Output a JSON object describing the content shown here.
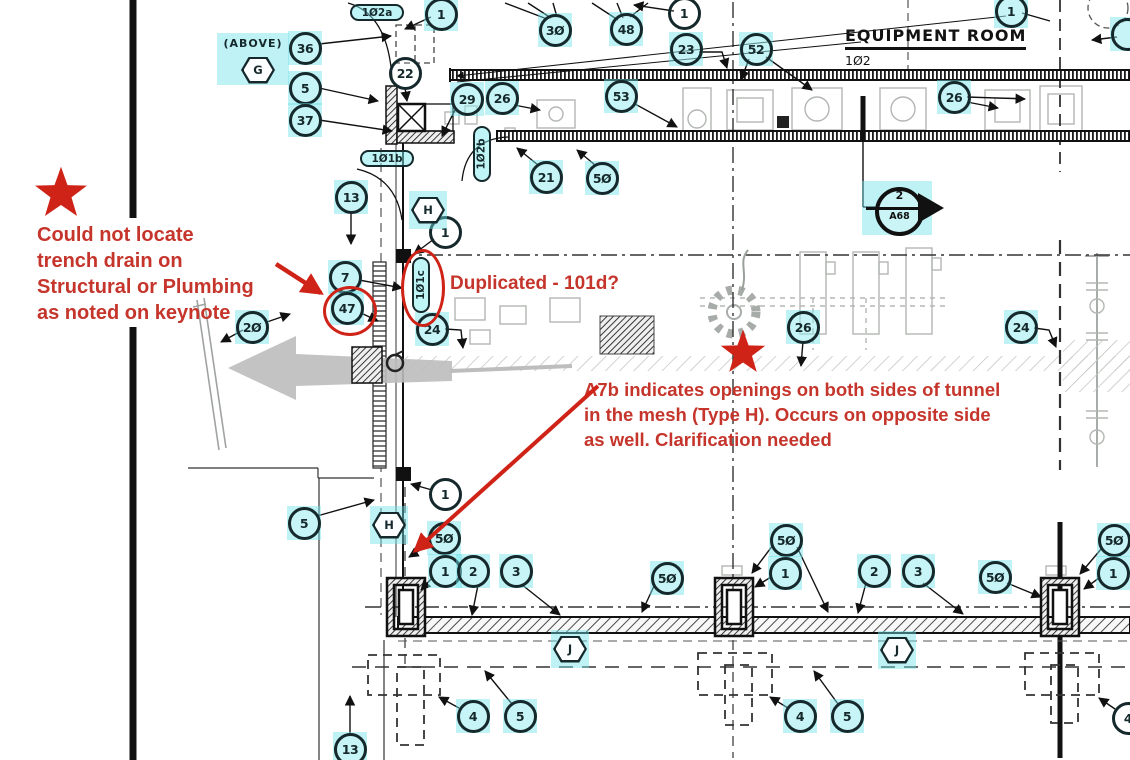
{
  "drawing": {
    "room": {
      "title": "EQUIPMENT ROOM",
      "number": "102"
    },
    "above_note": {
      "label": "(ABOVE)",
      "wall_type": "G"
    },
    "section_marker": {
      "detail_number": "2",
      "sheet": "A68"
    },
    "keynotes": [
      {
        "label": "1",
        "x": 441,
        "y": 14,
        "hl": true
      },
      {
        "label": "30",
        "x": 555,
        "y": 30,
        "hl": true
      },
      {
        "label": "48",
        "x": 626,
        "y": 29,
        "hl": true
      },
      {
        "label": "1",
        "x": 684,
        "y": 13,
        "hl": false
      },
      {
        "label": "23",
        "x": 686,
        "y": 49,
        "hl": true
      },
      {
        "label": "52",
        "x": 756,
        "y": 49,
        "hl": true
      },
      {
        "label": "26",
        "x": 954,
        "y": 97,
        "hl": true
      },
      {
        "label": "1",
        "x": 1011,
        "y": 11,
        "hl": true
      },
      {
        "label": "",
        "x": 1127,
        "y": 34,
        "hl": true
      },
      {
        "label": "29",
        "x": 467,
        "y": 99,
        "hl": true
      },
      {
        "label": "26",
        "x": 502,
        "y": 98,
        "hl": true
      },
      {
        "label": "53",
        "x": 621,
        "y": 96,
        "hl": true
      },
      {
        "label": "21",
        "x": 546,
        "y": 177,
        "hl": true
      },
      {
        "label": "50",
        "x": 602,
        "y": 178,
        "hl": true
      },
      {
        "label": "36",
        "x": 305,
        "y": 48,
        "hl": true
      },
      {
        "label": "5",
        "x": 305,
        "y": 88,
        "hl": true
      },
      {
        "label": "37",
        "x": 305,
        "y": 120,
        "hl": true
      },
      {
        "label": "22",
        "x": 405,
        "y": 73,
        "hl": false
      },
      {
        "label": "13",
        "x": 351,
        "y": 197,
        "hl": true
      },
      {
        "label": "1",
        "x": 445,
        "y": 232,
        "hl": false
      },
      {
        "label": "7",
        "x": 345,
        "y": 277,
        "hl": true
      },
      {
        "label": "47",
        "x": 347,
        "y": 308,
        "hl": true,
        "flagged": true
      },
      {
        "label": "20",
        "x": 252,
        "y": 327,
        "hl": true
      },
      {
        "label": "24",
        "x": 432,
        "y": 329,
        "hl": true
      },
      {
        "label": "26",
        "x": 803,
        "y": 327,
        "hl": true
      },
      {
        "label": "24",
        "x": 1021,
        "y": 327,
        "hl": true
      },
      {
        "label": "5",
        "x": 304,
        "y": 523,
        "hl": true
      },
      {
        "label": "1",
        "x": 445,
        "y": 494,
        "hl": false
      },
      {
        "label": "50",
        "x": 444,
        "y": 538,
        "hl": true
      },
      {
        "label": "1",
        "x": 445,
        "y": 571,
        "hl": true
      },
      {
        "label": "2",
        "x": 473,
        "y": 571,
        "hl": true
      },
      {
        "label": "3",
        "x": 516,
        "y": 571,
        "hl": true
      },
      {
        "label": "50",
        "x": 667,
        "y": 578,
        "hl": true
      },
      {
        "label": "50",
        "x": 786,
        "y": 540,
        "hl": true
      },
      {
        "label": "1",
        "x": 785,
        "y": 573,
        "hl": true
      },
      {
        "label": "2",
        "x": 874,
        "y": 571,
        "hl": true
      },
      {
        "label": "3",
        "x": 918,
        "y": 571,
        "hl": true
      },
      {
        "label": "50",
        "x": 995,
        "y": 577,
        "hl": true
      },
      {
        "label": "50",
        "x": 1114,
        "y": 540,
        "hl": true
      },
      {
        "label": "1",
        "x": 1113,
        "y": 573,
        "hl": true
      },
      {
        "label": "4",
        "x": 473,
        "y": 716,
        "hl": true
      },
      {
        "label": "5",
        "x": 520,
        "y": 716,
        "hl": true
      },
      {
        "label": "4",
        "x": 800,
        "y": 716,
        "hl": true
      },
      {
        "label": "5",
        "x": 847,
        "y": 716,
        "hl": true
      },
      {
        "label": "4",
        "x": 1128,
        "y": 718,
        "hl": false
      },
      {
        "label": "13",
        "x": 350,
        "y": 749,
        "hl": true
      }
    ],
    "wall_type_tags": [
      {
        "label": "G",
        "x": 258,
        "y": 70,
        "hl": false
      },
      {
        "label": "H",
        "x": 428,
        "y": 210,
        "hl": true
      },
      {
        "label": "H",
        "x": 389,
        "y": 525,
        "hl": true
      },
      {
        "label": "J",
        "x": 570,
        "y": 649,
        "hl": true
      },
      {
        "label": "J",
        "x": 897,
        "y": 650,
        "hl": true
      }
    ],
    "door_tags": [
      {
        "label": "102a",
        "x": 377,
        "y": 13,
        "orient": "h"
      },
      {
        "label": "101b",
        "x": 387,
        "y": 159,
        "orient": "h"
      },
      {
        "label": "102b",
        "x": 482,
        "y": 154,
        "orient": "v"
      },
      {
        "label": "101c",
        "x": 421,
        "y": 285,
        "orient": "v",
        "flagged": true
      }
    ]
  },
  "markup": {
    "notes": [
      {
        "id": "note-trench",
        "lines": [
          "Could not locate",
          "trench drain on",
          "Structural or Plumbing",
          "as noted on keynote"
        ],
        "x": 37,
        "y": 222,
        "font_px": 20,
        "line_px": 26
      },
      {
        "id": "note-duplicated",
        "lines": [
          "Duplicated - 101d?"
        ],
        "x": 450,
        "y": 272,
        "font_px": 19,
        "line_px": 24
      },
      {
        "id": "note-a7b",
        "lines": [
          "A7b indicates openings on both sides of tunnel",
          "in the mesh (Type H). Occurs on opposite side",
          "as well. Clarification needed"
        ],
        "x": 584,
        "y": 377,
        "font_px": 18.5,
        "line_px": 25
      }
    ],
    "stars": [
      {
        "x": 61,
        "y": 194,
        "scale": 1.05
      },
      {
        "x": 743,
        "y": 353,
        "scale": 0.9
      }
    ],
    "flagged_keynote": "47",
    "flagged_door_tag": "101c"
  },
  "colors": {
    "highlight_cyan": "rgba(110,226,232,0.45)",
    "ink": "#15282b",
    "markup_red": "#cf2318",
    "markup_red_text": "#c5352b",
    "equipment_gray": "#b3b7b3"
  }
}
